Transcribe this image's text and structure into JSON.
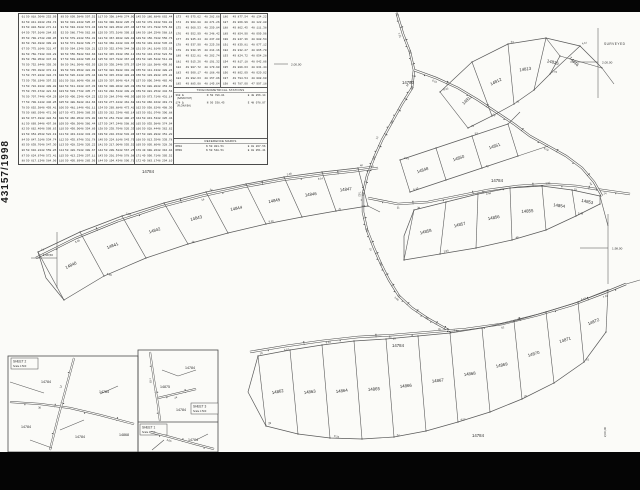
{
  "document": {
    "reference_number": "43157/1998",
    "surveyed_label": "SURVEYED"
  },
  "coordinate_table": {
    "groups": [
      {
        "rows": [
          "61|50 818.36|48 252.09",
          "62|50 811.02|48 263.74",
          "63|50 804.58|48 271.12",
          "64|50 797.91|48 284.63",
          "65|50 790.27|48 296.05",
          "66|50 782.49|48 309.82",
          "67|50 775.16|48 321.47",
          "68|50 768.73|48 334.28",
          "69|50 760.05|48 347.91",
          "70|50 752.64|48 359.36",
          "71|50 745.38|48 372.18",
          "72|50 737.82|48 384.74",
          "73|50 730.19|48 397.52",
          "74|50 722.91|48 409.08",
          "75|50 715.47|48 421.63",
          "76|50 707.74|48 434.29",
          "77|50 700.12|48 446.85",
          "78|50 692.58|48 459.41",
          "79|50 685.03|48 471.96",
          "80|50 677.49|48 484.52",
          "81|50 669.94|48 497.08",
          "82|50 662.40|48 509.63",
          "83|50 654.85|48 522.19",
          "84|50 647.31|48 534.74",
          "85|50 639.76|48 547.30",
          "86|50 632.22|48 559.85",
          "87|50 624.67|48 572.41",
          "88|50 617.13|48 584.96"
        ]
      },
      {
        "rows": [
          "89|50 609.58|48 597.52",
          "90|50 601.84|48 585.97",
          "91|50 594.31|48 574.43",
          "92|50 586.77|48 562.88",
          "93|50 579.22|48 551.32",
          "94|50 571.68|48 539.77",
          "95|50 564.13|48 528.21",
          "96|50 556.59|48 516.66",
          "97|50 549.04|48 505.10",
          "98|50 541.50|48 493.55",
          "99|50 533.95|48 481.99",
          "100|50 526.41|48 470.44",
          "101|50 518.86|48 458.88",
          "102|50 511.32|48 447.33",
          "103|50 503.77|48 435.77",
          "104|50 496.23|48 424.22",
          "105|50 488.68|48 412.66",
          "106|50 481.14|48 401.11",
          "107|50 473.59|48 389.55",
          "108|50 466.05|48 378.00",
          "109|50 458.50|48 366.44",
          "110|50 450.96|48 354.89",
          "111|50 443.41|48 343.33",
          "112|50 435.87|48 331.78",
          "113|50 428.32|48 320.22",
          "114|50 420.78|48 308.67",
          "115|50 413.23|48 297.11",
          "116|50 405.69|48 285.56"
        ]
      },
      {
        "rows": [
          "117|50 398.14|48 274.00",
          "118|50 390.60|48 285.73",
          "119|50 383.05|48 297.46",
          "120|50 375.51|48 309.19",
          "121|50 367.96|48 320.92",
          "122|50 360.42|48 332.65",
          "123|50 352.87|48 344.38",
          "124|50 345.33|48 356.11",
          "125|50 337.78|48 367.84",
          "126|50 330.24|48 379.57",
          "127|50 322.69|48 391.30",
          "128|50 315.15|48 403.03",
          "129|50 307.60|48 414.76",
          "130|50 300.06|48 426.49",
          "131|50 292.51|48 438.22",
          "132|50 284.97|48 449.95",
          "133|50 277.42|48 461.68",
          "134|50 269.88|48 473.41",
          "135|50 262.33|48 485.14",
          "136|50 254.79|48 496.87",
          "137|50 247.24|48 508.60",
          "138|50 239.70|48 520.33",
          "139|50 232.15|48 532.06",
          "140|50 224.61|48 543.79",
          "141|50 217.06|48 555.52",
          "142|50 209.52|48 567.25",
          "143|50 201.97|48 578.98",
          "144|50 194.43|48 590.71"
        ]
      },
      {
        "rows": [
          "145|50 186.88|48 602.44",
          "146|50 179.34|48 591.02",
          "147|50 171.79|48 579.60",
          "148|50 164.25|48 568.18",
          "149|50 156.70|48 556.76",
          "150|50 149.16|48 545.34",
          "151|50 141.61|48 533.92",
          "152|50 134.07|48 522.50",
          "153|50 126.52|48 511.08",
          "154|50 118.98|48 499.66",
          "155|50 111.43|48 488.24",
          "156|50 103.89|48 476.82",
          "157|50 096.34|48 465.40",
          "158|50 088.80|48 453.98",
          "159|50 081.25|48 442.56",
          "160|50 073.71|48 431.14",
          "161|50 066.16|48 419.72",
          "162|50 058.62|48 408.30",
          "163|50 051.07|48 396.88",
          "164|50 043.53|48 385.46",
          "165|50 035.98|48 374.04",
          "166|50 028.44|48 362.62",
          "167|50 020.89|48 351.20",
          "168|50 013.35|48 339.78",
          "169|50 005.80|48 328.36",
          "170|49 998.26|48 316.94",
          "171|49 990.71|48 305.52",
          "172|49 983.17|48 294.10"
        ]
      },
      {
        "rows": [
          "173|49 975.62|48 282.68",
          "174|49 968.08|48 271.26",
          "175|49 960.53|48 259.84",
          "176|49 952.99|48 248.42",
          "177|49 945.44|48 237.00",
          "178|49 937.90|48 225.58",
          "179|49 930.35|48 214.16",
          "180|49 922.81|48 202.74",
          "181|49 915.26|48 191.32",
          "182|49 907.72|48 179.90",
          "183|49 900.17|48 168.48",
          "184|49 892.63|48 157.06",
          "185|49 885.08|48 145.64"
        ]
      },
      {
        "rows": [
          "186|49 877.54|48 134.22",
          "187|49 869.99|48 122.80",
          "188|49 862.45|48 111.38",
          "189|49 854.90|48 099.96",
          "190|49 847.36|48 088.54",
          "191|49 839.81|48 077.12",
          "192|49 832.27|48 065.70",
          "193|49 824.72|48 054.28",
          "194|49 817.18|48 042.86",
          "195|49 809.63|48 031.44",
          "196|49 802.09|48 020.02",
          "197|49 794.54|48 008.60",
          "198|49 787.00|47 997.18"
        ]
      }
    ]
  },
  "trig_box": {
    "title": "TRIGONOMETRICAL STATIONS",
    "entries": [
      {
        "id": "398 Δ",
        "n": "N 50 786.01",
        "e": "E 48 856.14",
        "name": "(SANKOYAT)"
      },
      {
        "id": "174 Δ",
        "n": "N 50 538.45",
        "e": "E 48 078.07",
        "name": "(FLOKA BA)"
      }
    ]
  },
  "reference_marks": {
    "title": "REFERENCE MARKS",
    "rows": [
      [
        "RM10",
        "N 50 001.51",
        "E 48 267.56"
      ],
      [
        "RM30",
        "N 50 548.51",
        "E 48 051.41"
      ]
    ]
  },
  "grid_marks": [
    {
      "label": "2,00,00",
      "x": 598,
      "y": 62,
      "kind": "cross-left"
    },
    {
      "label": "2,00,00",
      "x": 288,
      "y": 64,
      "kind": "tick"
    },
    {
      "label": "1,98,50",
      "x": 57,
      "y": 258,
      "kind": "cross-labelleft"
    },
    {
      "label": "1,98,00",
      "x": 608,
      "y": 248,
      "kind": "cross-left"
    },
    {
      "label": "2,00,00",
      "x": 606,
      "y": 432,
      "kind": "vtext"
    }
  ],
  "map": {
    "road_label": "14784",
    "extra_labels": [
      {
        "t": "14784",
        "x": 148,
        "y": 173
      },
      {
        "t": "14780",
        "x": 408,
        "y": 84
      },
      {
        "t": "14784",
        "x": 497,
        "y": 182
      },
      {
        "t": "14784",
        "x": 398,
        "y": 347
      },
      {
        "t": "14784",
        "x": 478,
        "y": 437
      }
    ],
    "bands": {
      "tl": [
        "14840",
        "14841",
        "14842",
        "14843",
        "14844",
        "14845",
        "14846",
        "14847"
      ],
      "tc": [
        "14848",
        "14850",
        "14851"
      ],
      "tr": [
        "14811",
        "14812",
        "14813",
        "14815",
        "14816"
      ],
      "mr": [
        "14858",
        "14857",
        "14856",
        "14855",
        "14854",
        "14853"
      ],
      "bc": [
        "14862",
        "14863",
        "14864",
        "14865",
        "14866",
        "14867",
        "14868",
        "14869",
        "14870",
        "14871",
        "14872"
      ]
    },
    "point_label_pool": [
      "12",
      "7.62",
      "24",
      "3.05",
      "48",
      "5.49",
      "16",
      "9.14",
      "31",
      "2.44",
      "53",
      "6.10",
      "28",
      "8.23",
      "44",
      "4.57",
      "19",
      "61",
      "7.01",
      "36"
    ]
  },
  "insets": {
    "a": {
      "title": "SHEET 2",
      "scale": "Scale 1:500",
      "labels": [
        {
          "t": "14784",
          "x": 46,
          "y": 383
        },
        {
          "t": "14784",
          "x": 104,
          "y": 393
        },
        {
          "t": "14784",
          "x": 26,
          "y": 428
        },
        {
          "t": "14784",
          "x": 80,
          "y": 438
        },
        {
          "t": "14868",
          "x": 124,
          "y": 436
        }
      ]
    },
    "b": {
      "title": "SHEET 3",
      "scale": "Scale 1:500",
      "labels": [
        {
          "t": "14784",
          "x": 190,
          "y": 369
        },
        {
          "t": "14875",
          "x": 165,
          "y": 388
        },
        {
          "t": "14784",
          "x": 181,
          "y": 411
        }
      ]
    },
    "c": {
      "title": "SHEET 1",
      "scale": "Scale 1:500",
      "labels": [
        {
          "t": "14784",
          "x": 193,
          "y": 441
        }
      ]
    }
  }
}
